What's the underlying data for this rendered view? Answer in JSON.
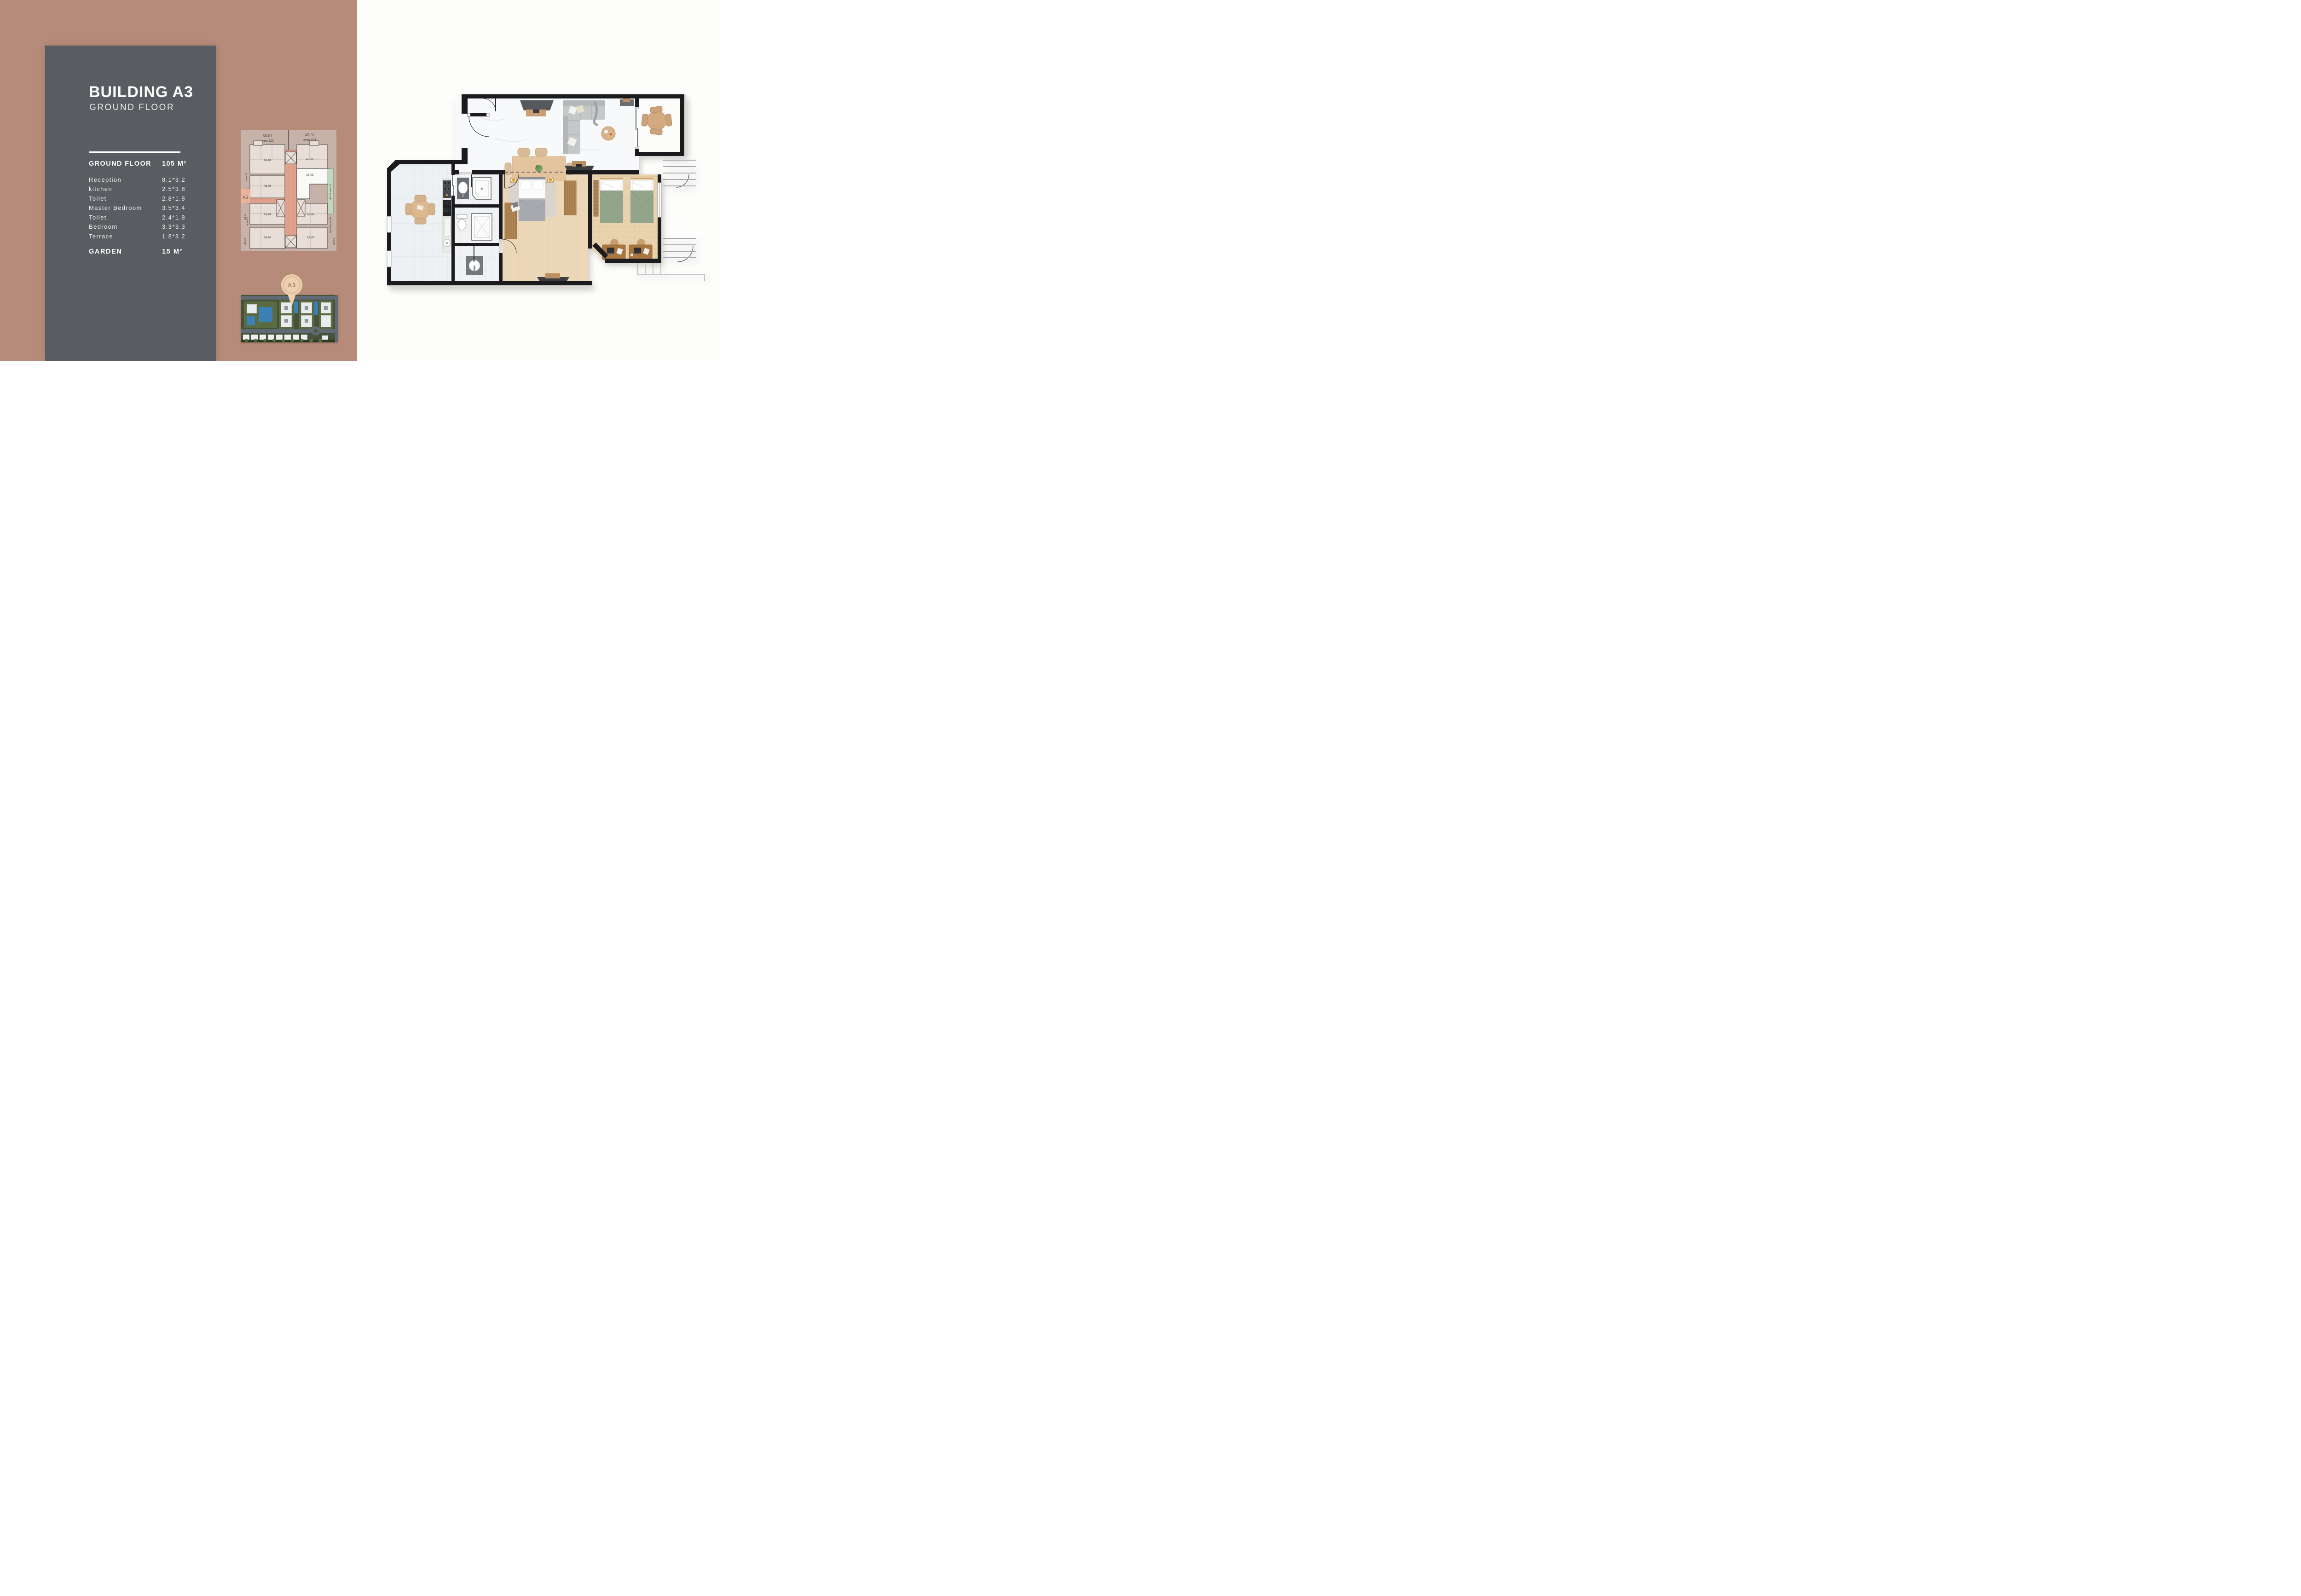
{
  "page": {
    "background_terracotta": "#b68b7a",
    "background_right": "#fdfdfc",
    "panel_color": "#595c60"
  },
  "info_panel": {
    "title": "BUILDING A3",
    "subtitle": "GROUND FLOOR",
    "area_table": {
      "header": {
        "label": "GROUND FLOOR",
        "value": "105 M²"
      },
      "rows": [
        {
          "label": "Reception",
          "value": "8.1*3.2"
        },
        {
          "label": "kitchen",
          "value": "2.5*3.8"
        },
        {
          "label": "Toilet",
          "value": "2.8*1.8"
        },
        {
          "label": "Master Bedroom",
          "value": "3.5*3.4"
        },
        {
          "label": "Toilet",
          "value": "2.4*1.8"
        },
        {
          "label": "Bedroom",
          "value": "3.3*3.3"
        },
        {
          "label": "Terrace",
          "value": "1.8*3.2"
        }
      ],
      "footer": {
        "label": "GARDEN",
        "value": "15 M²"
      }
    }
  },
  "key_plan": {
    "header_left_unit": "A3-01",
    "header_left_area": "area  120",
    "header_right_unit": "A3-02",
    "header_right_area": "area  104",
    "building_tab": "A3",
    "highlighted_unit": "A3-03",
    "unit_labels": {
      "u1": "A3-01",
      "u2": "A3-02",
      "u3": "A3-03",
      "u4": "A3-04",
      "u5": "A3-05",
      "u6": "A3-06",
      "u7": "A3-07",
      "u8": "A3-08"
    },
    "side_labels": {
      "left_area_top": "area 15",
      "left_unit_mid": "A3-07",
      "left_area_mid": "area 21",
      "left_unit_bottom": "A3-08",
      "right_garden": "A3-03  area 18",
      "right_lower": "A3-04  area 18",
      "right_bottom": "A3-05"
    },
    "colors": {
      "card": "#c7b2a9",
      "unit_fill": "#e9ded7",
      "corridor": "#e0a28c",
      "highlight": "#fafaf8",
      "garden": "#c2d7ba"
    }
  },
  "site_map": {
    "pin_label": "A3",
    "colors": {
      "greens": "#47523a",
      "road": "#5f6a74",
      "pool": "#3c80b6",
      "pin": "#ecd0b0"
    }
  },
  "floor_plan": {
    "colors": {
      "wall": "#1b1b1d",
      "marble": "#eef1f4",
      "interior": "#f8f9fa",
      "wood_floor": "#ecd8b8",
      "duvet_green": "#92a58a",
      "duvet_gray": "#a6a9ad",
      "sofa_gray": "#c5c8c9",
      "wood_furniture": "#d6ae83",
      "rail": "#a6abae"
    }
  }
}
